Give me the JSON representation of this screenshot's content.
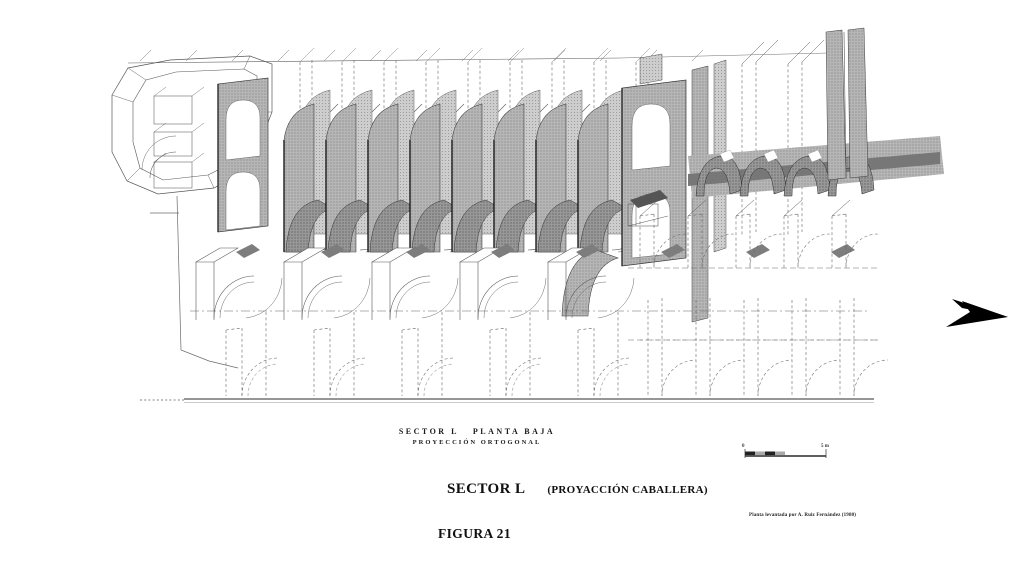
{
  "figure": {
    "caption": {
      "sector": "SECTOR L",
      "plan": "PLANTA BAJA",
      "projection_line": "PROYECCIÓN ORTOGONAL"
    },
    "title": {
      "sector": "SECTOR L",
      "projection": "(PROYACCIÓN CABALLERA)"
    },
    "figure_number": "FIGURA 21",
    "credit": "Planta levantada por A. Ruiz Fernández (1980)",
    "scale_bar": {
      "start_label": "0",
      "end_label": "5 m"
    },
    "icons": {
      "direction_arrow": "direction-arrow"
    },
    "colors": {
      "ink": "#151515",
      "halftone_mid": "#b3b3b3",
      "halftone_light": "#cccccc",
      "halftone_dark": "#8f8f8f",
      "paper": "#ffffff"
    }
  }
}
